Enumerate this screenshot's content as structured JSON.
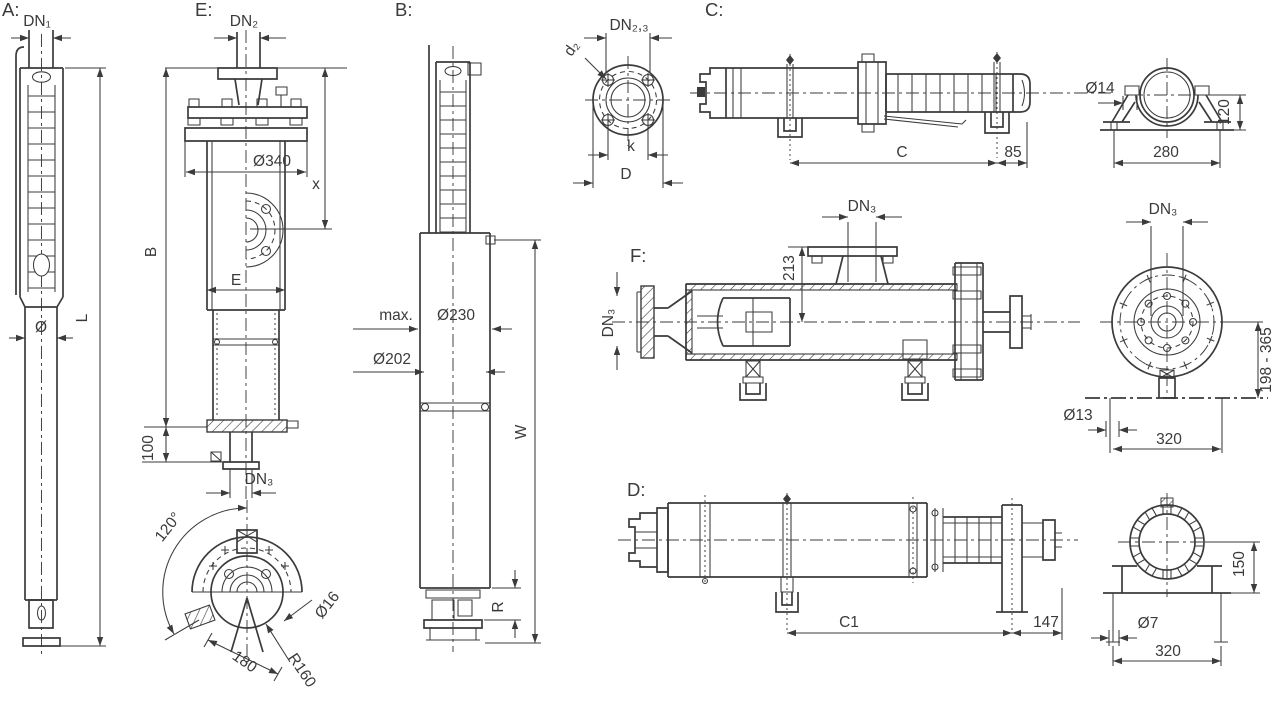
{
  "views": {
    "a": {
      "label": "A:",
      "dn1": "DN₁",
      "dia": "Ø",
      "length": "L"
    },
    "e": {
      "label": "E:",
      "dn2": "DN₂",
      "flange_dia": "Ø340",
      "x": "x",
      "e": "E",
      "b": "B",
      "h100": "100",
      "dn3": "DN₃",
      "angle": "120°",
      "spacing": "180",
      "radius": "R160",
      "hole": "Ø16"
    },
    "b": {
      "label": "B:",
      "max_label": "max.",
      "dia230": "Ø230",
      "dia202": "Ø202",
      "w": "W",
      "r": "R"
    },
    "flange_top": {
      "dn23": "DN₂,₃",
      "d2": "d₂",
      "k": "k",
      "d": "D"
    },
    "c": {
      "label": "C:",
      "c": "C",
      "n85": "85"
    },
    "c_end": {
      "dia14": "Ø14",
      "h120": "120",
      "w280": "280"
    },
    "f": {
      "label": "F:",
      "dn3_top": "DN₃",
      "h213": "213",
      "dn3_side": "DN₃"
    },
    "f_end": {
      "dn3": "DN₃",
      "range": "198 - 365",
      "dia13": "Ø13",
      "w320": "320"
    },
    "d": {
      "label": "D:",
      "c1": "C1",
      "n147": "147"
    },
    "d_end": {
      "h150": "150",
      "dia7": "Ø7",
      "w320": "320"
    }
  }
}
